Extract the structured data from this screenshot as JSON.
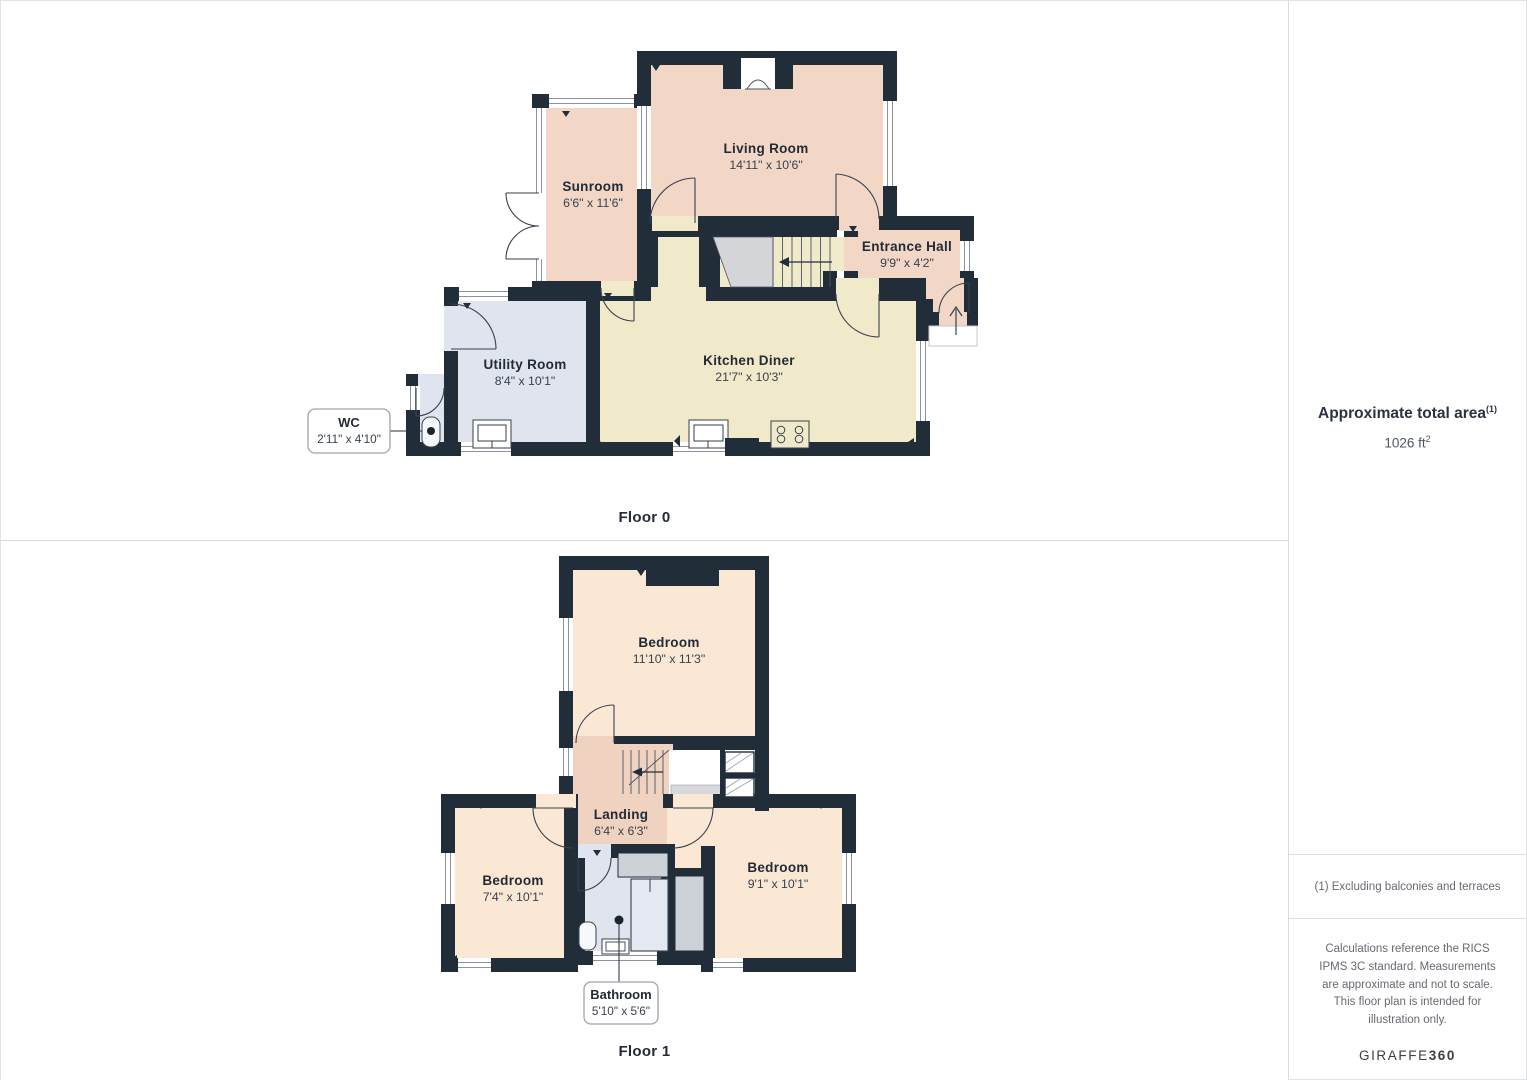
{
  "floors": [
    {
      "label": "Floor 0",
      "rooms": [
        {
          "name": "Sunroom",
          "dims": "6'6\" x 11'6\""
        },
        {
          "name": "Living Room",
          "dims": "14'11\" x 10'6\""
        },
        {
          "name": "Entrance Hall",
          "dims": "9'9\" x 4'2\""
        },
        {
          "name": "Utility Room",
          "dims": "8'4\" x 10'1\""
        },
        {
          "name": "Kitchen Diner",
          "dims": "21'7\" x 10'3\""
        }
      ],
      "callout": {
        "name": "WC",
        "dims": "2'11\" x 4'10\""
      }
    },
    {
      "label": "Floor 1",
      "rooms": [
        {
          "name": "Bedroom",
          "dims": "11'10\" x 11'3\""
        },
        {
          "name": "Landing",
          "dims": "6'4\" x 6'3\""
        },
        {
          "name": "Bedroom",
          "dims": "7'4\" x 10'1\""
        },
        {
          "name": "Bedroom",
          "dims": "9'1\" x 10'1\""
        }
      ],
      "callout": {
        "name": "Bathroom",
        "dims": "5'10\" x 5'6\""
      }
    }
  ],
  "sidebar": {
    "title": "Approximate total area",
    "title_superscript": "(1)",
    "area_value": "1026 ft",
    "area_superscript": "2",
    "footnote": "(1) Excluding balconies and terraces",
    "disclaimer": "Calculations reference the RICS IPMS 3C standard. Measurements are approximate and not to scale. This floor plan is intended for illustration only.",
    "brand": {
      "name": "GIRAFFE",
      "suffix": "360"
    }
  },
  "colors": {
    "wall": "#222d3a",
    "room_pink": "#f2d7c7",
    "room_peach": "#fbe8d4",
    "landing_pink": "#f0d2c1",
    "kitchen_beige": "#f0e9ca",
    "wet_room_blue": "#dfe4ee",
    "stairs_gray": "#d3d5d9"
  }
}
